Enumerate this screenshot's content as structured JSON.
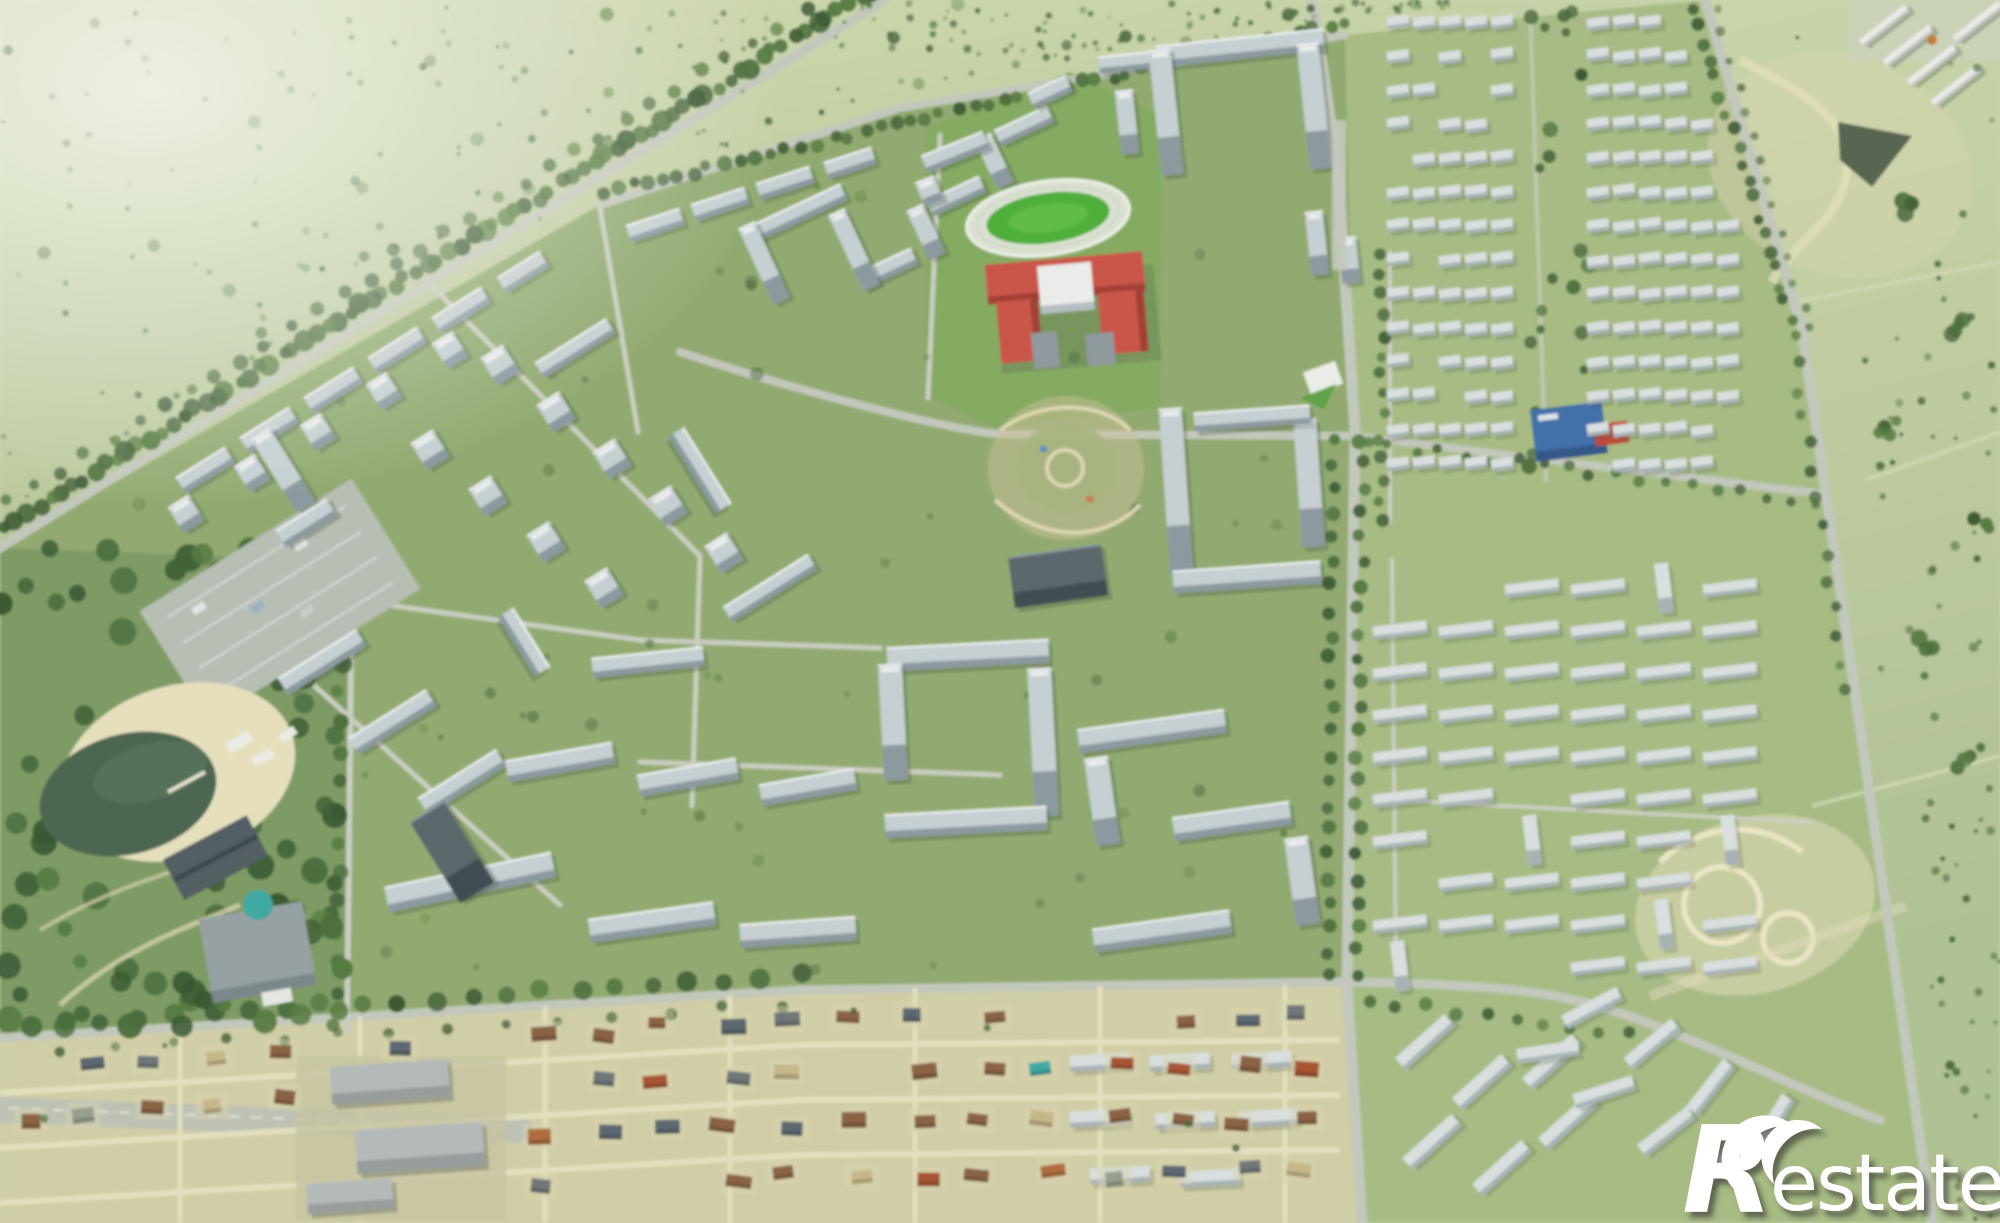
{
  "watermark": {
    "logo_r": "R",
    "wordmark": "estate",
    "full_text": "Restate"
  },
  "palette": {
    "field_top": "#c2cfa4",
    "field_right": "#c9d5ab",
    "district_green": "#92aa70",
    "lake_park_green": "#7d9a64",
    "lawn_green": "#83aa5e",
    "road": "#c6cabf",
    "road_minor": "#cdd0c5",
    "tree_dark": "#3f5e34",
    "building_roof": "#c9d1d6",
    "building_side": "#8c98a1",
    "school_red": "#cd5347",
    "stadium_track": "#dfe4d6",
    "stadium_field": "#4caf36",
    "water": "#49634f",
    "sand": "#e9e2c0",
    "village_ground": "#d3d0a8",
    "village_road": "#e6e2c2",
    "pool_teal": "#3aa9a4",
    "kinder_blue": "#3e6cab",
    "watermark": "#ffffff",
    "watermark_shadow": "#2f2f2f"
  }
}
